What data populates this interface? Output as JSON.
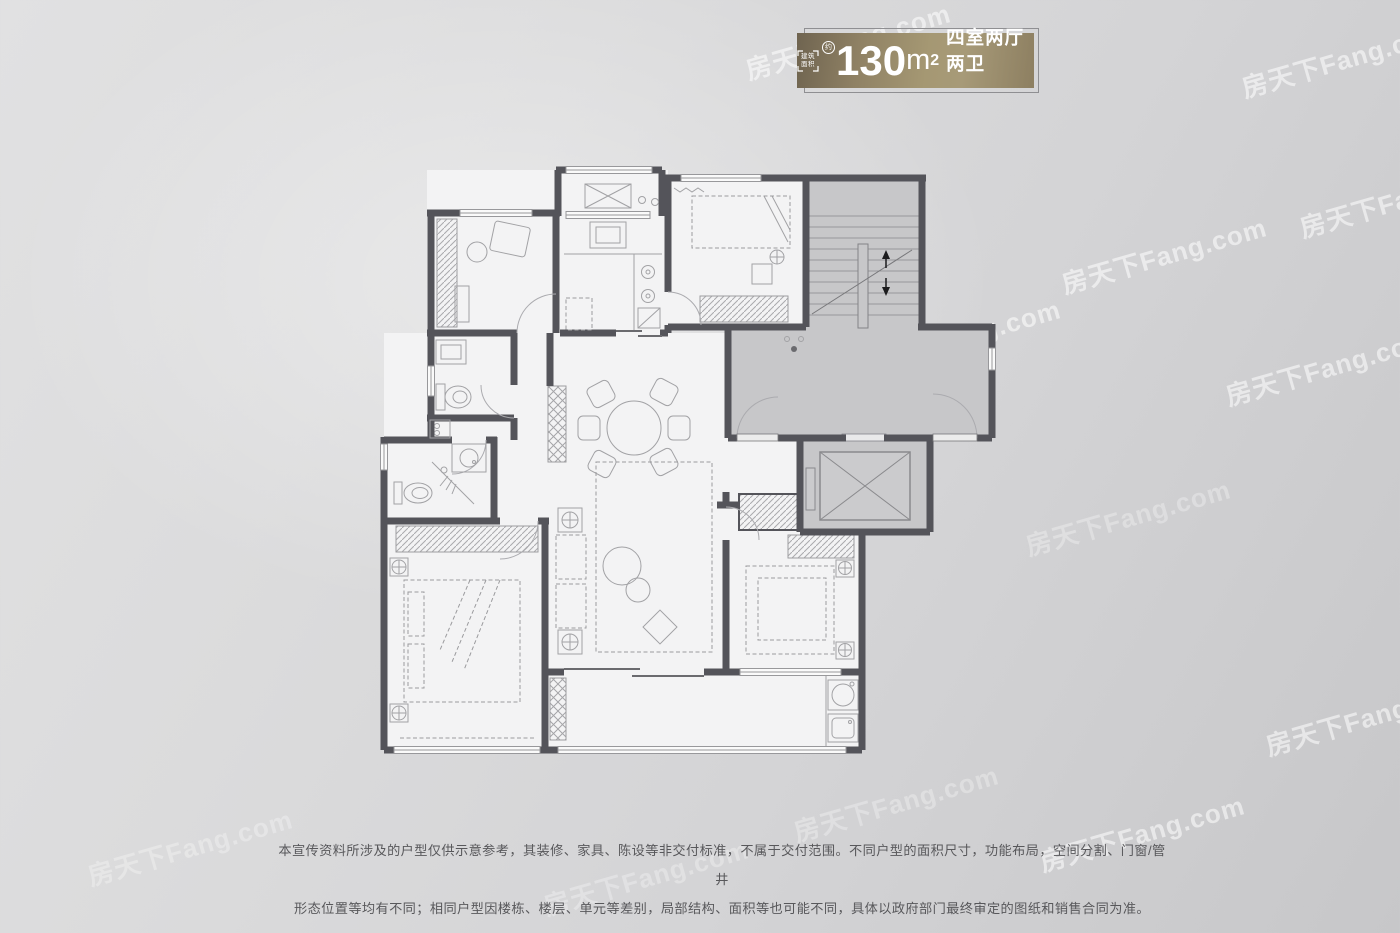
{
  "badge": {
    "area_label": "建筑面积",
    "approx": "约",
    "value": "130",
    "unit": "m",
    "sup": "2",
    "rooms": "四室两厅两卫",
    "gold_gradient": [
      "#6f6450",
      "#a79a78",
      "#8d7f61"
    ],
    "text_color": "#ffffff"
  },
  "watermark": {
    "text": "房天下Fang.com"
  },
  "disclaimer": {
    "lines": [
      "本宣传资料所涉及的户型仅供示意参考，其装修、家具、陈设等非交付标准，不属于交付范围。不同户型的面积尺寸，功能布局，空间分割、门窗/管井",
      "形态位置等均有不同；相同户型因楼栋、楼层、单元等差别，局部结构、面积等也可能不同，具体以政府部门最终审定的图纸和销售合同为准。"
    ]
  },
  "floor_plan": {
    "depicted_elements": [
      "bedroom-top-left",
      "kitchen",
      "kitchen-balcony",
      "bedroom-top-right",
      "stairwell",
      "public-corridor",
      "elevator",
      "bathroom-upper",
      "bathroom-lower",
      "dining-round-table",
      "living-room",
      "master-bedroom",
      "bedroom-bottom-right",
      "balcony",
      "laundry-corner"
    ],
    "colors": {
      "wall": "#54545a",
      "public_area_fill": "#c7c7c9",
      "room_fill": "#f3f3f4",
      "furniture_line": "#a2a2a5",
      "page_background": "#d6d6d8"
    }
  }
}
